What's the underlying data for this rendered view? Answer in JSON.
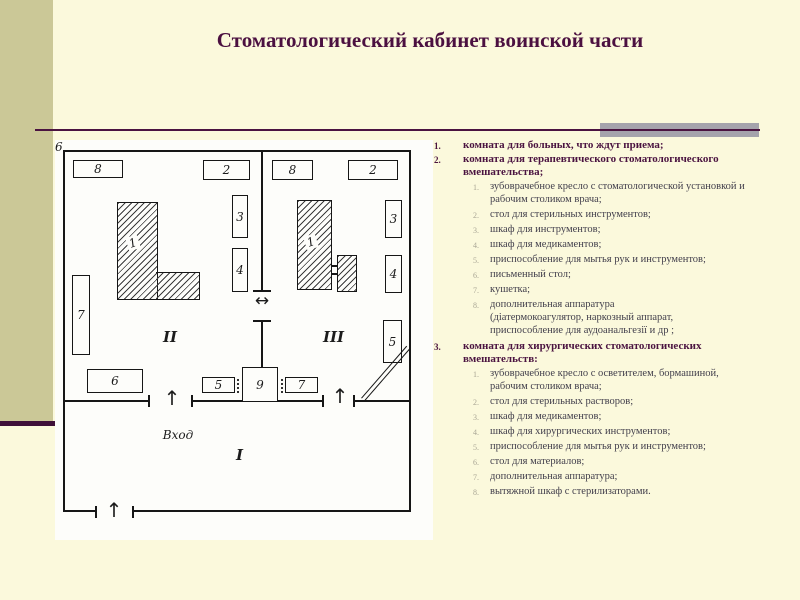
{
  "slide": {
    "title": "Стоматологический кабинет воинской части"
  },
  "colors": {
    "background": "#fbf9dc",
    "left_bar_olive": "#cbc897",
    "accent_maroon": "#4a1340",
    "gray_bar": "#a5a3ac",
    "sub_text": "#413e4b",
    "sub_marker": "#a9a695"
  },
  "list": {
    "l1_markers": [
      "1.",
      "2.",
      "3."
    ],
    "l2_markers": [
      "1.",
      "2.",
      "3.",
      "4.",
      "5.",
      "6.",
      "7.",
      "8."
    ],
    "items": [
      {
        "text": "комната для больных, что ждут приема;",
        "sub": []
      },
      {
        "text": "комната для терапевтического стоматологического вмешательства;",
        "sub": [
          "зубоврачебное кресло с стоматологической установкой и рабочим столиком врача;",
          "стол для стерильных инструментов;",
          "шкаф для инструментов;",
          "шкаф для медикаментов;",
          "приспособление для мытья рук и инструментов;",
          "письменный стол;",
          "кушетка;",
          "дополнительная аппаратура\n(діатермокоагулятор, наркозный аппарат,\nприспособление для аудоанальгезії и др ;"
        ]
      },
      {
        "text": "комната для хирургических стоматологических вмешательств:",
        "sub": [
          "зубоврачебное кресло с осветителем, бормашиной, рабочим столиком врача;",
          "стол для стерильных растворов;",
          "шкаф для медикаментов;",
          "шкаф для хирургических инструментов;",
          "приспособление для мытья рук и инструментов;",
          "стол для материалов;",
          "дополнительная аппаратура;",
          "вытяжной шкаф с стерилизаторами."
        ]
      }
    ]
  },
  "floorplan": {
    "entrance_label": "Вход",
    "room_numbers": {
      "left": "II",
      "right": "III",
      "bottom": "I"
    },
    "item_labels": {
      "l8": "8",
      "l2": "2",
      "l1": "1",
      "l3": "3",
      "l4": "4",
      "l7": "7",
      "l6": "6",
      "r8": "8",
      "r2": "2",
      "r1": "1",
      "r3": "3",
      "r4": "4",
      "r5": "5",
      "r6": "6",
      "c5": "5",
      "c9": "9",
      "c7": "7"
    },
    "icons": {
      "up_arrow": "↑",
      "double_arrow": "↔"
    }
  }
}
